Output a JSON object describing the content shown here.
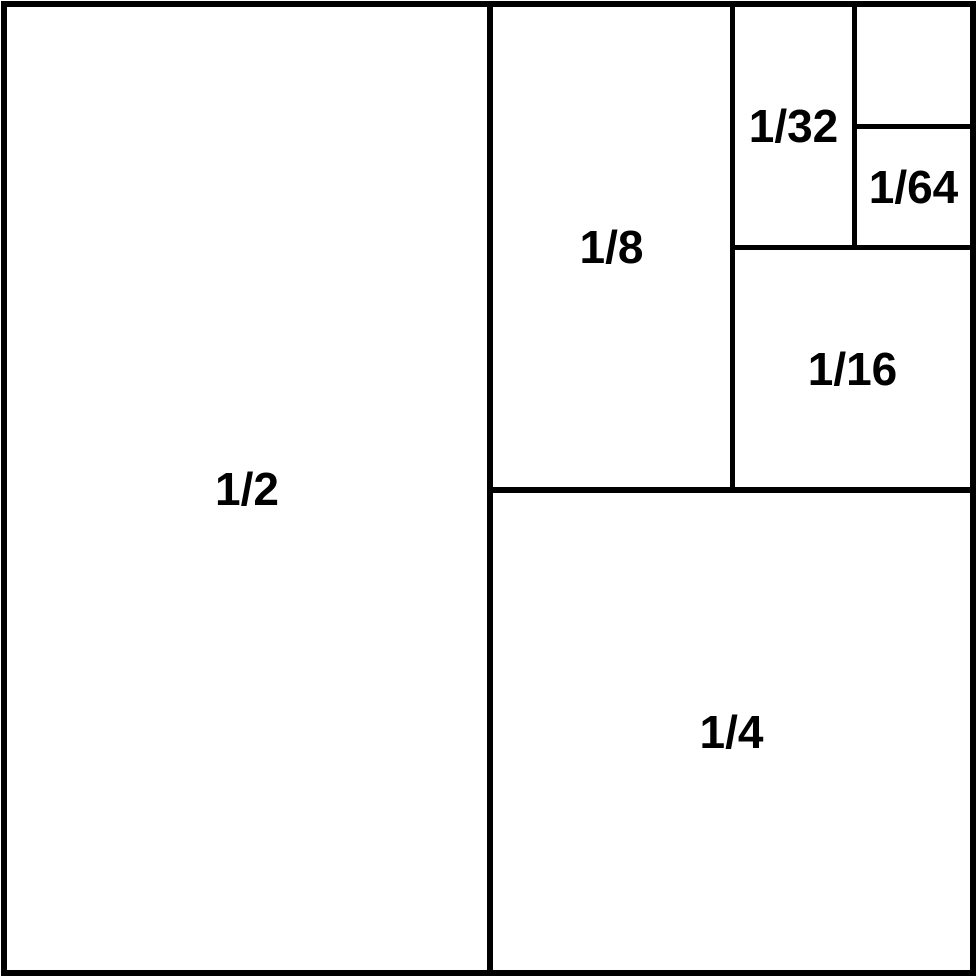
{
  "diagram": {
    "description_colors": {
      "line": "#000000",
      "background": "#ffffff",
      "text": "#000000"
    },
    "regions": [
      {
        "id": "half",
        "label": "1/2"
      },
      {
        "id": "quarter",
        "label": "1/4"
      },
      {
        "id": "eighth",
        "label": "1/8"
      },
      {
        "id": "sixteenth",
        "label": "1/16"
      },
      {
        "id": "thirty-second",
        "label": "1/32"
      },
      {
        "id": "sixty-fourth",
        "label": "1/64"
      },
      {
        "id": "remainder",
        "label": ""
      }
    ]
  }
}
